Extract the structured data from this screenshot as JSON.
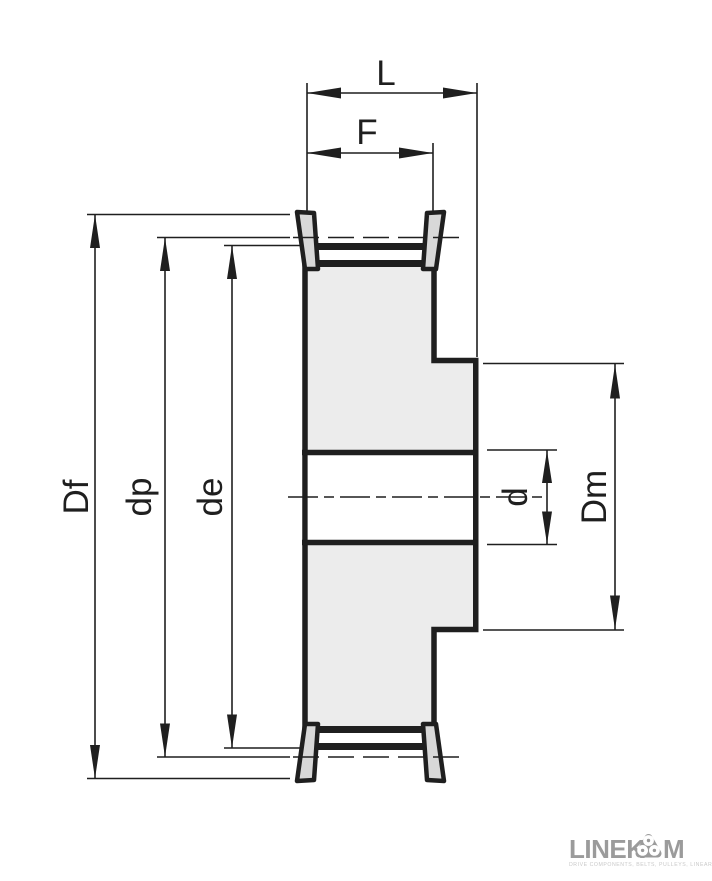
{
  "drawing": {
    "title": "timing-belt-pulley-cross-section",
    "dimensions": {
      "total_width": "L",
      "belt_face_width": "F",
      "flange_diameter": "Df",
      "pitch_diameter": "dp",
      "outside_diameter": "de",
      "bore_diameter": "d",
      "hub_diameter": "Dm"
    },
    "colors": {
      "line": "#1f1f1f",
      "body_fill": "#ececec",
      "flange_fill": "#d8d8d8",
      "bore_fill": "#ffffff"
    }
  },
  "branding": {
    "logo_text_left": "LINEK",
    "logo_text_right": "M",
    "logo_icon": "three-roller-icon",
    "logo_color": "#9b9b9b",
    "tagline_illegible": "DRIVE COMPONENTS, BELTS, PULLEYS, LINEAR SYSTEMS"
  }
}
